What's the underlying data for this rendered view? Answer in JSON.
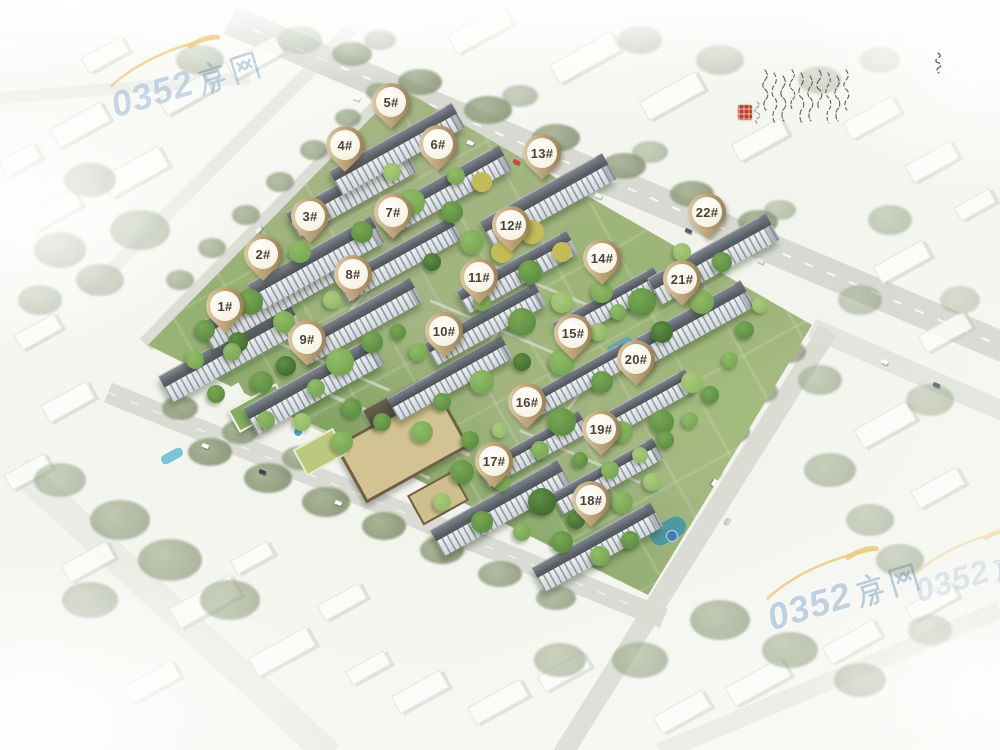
{
  "page": {
    "width": 1000,
    "height": 750,
    "description": "Aerial bird's-eye rendering of a residential compound masterplan with 22 numbered building markers"
  },
  "map": {
    "marker_style": {
      "ring_light": "#e6d7b7",
      "ring_dark": "#8a744c",
      "fill": "#fbf8ef",
      "text_color": "#4a4236"
    },
    "markers": [
      {
        "label": "1#",
        "x": 225,
        "y": 307
      },
      {
        "label": "2#",
        "x": 263,
        "y": 255
      },
      {
        "label": "3#",
        "x": 310,
        "y": 217
      },
      {
        "label": "4#",
        "x": 345,
        "y": 146
      },
      {
        "label": "5#",
        "x": 391,
        "y": 103
      },
      {
        "label": "6#",
        "x": 438,
        "y": 145
      },
      {
        "label": "7#",
        "x": 393,
        "y": 213
      },
      {
        "label": "8#",
        "x": 353,
        "y": 275
      },
      {
        "label": "9#",
        "x": 307,
        "y": 340
      },
      {
        "label": "10#",
        "x": 444,
        "y": 332
      },
      {
        "label": "11#",
        "x": 479,
        "y": 278
      },
      {
        "label": "12#",
        "x": 511,
        "y": 226
      },
      {
        "label": "13#",
        "x": 542,
        "y": 154
      },
      {
        "label": "14#",
        "x": 602,
        "y": 259
      },
      {
        "label": "15#",
        "x": 573,
        "y": 334
      },
      {
        "label": "16#",
        "x": 527,
        "y": 403
      },
      {
        "label": "17#",
        "x": 494,
        "y": 462
      },
      {
        "label": "18#",
        "x": 591,
        "y": 501
      },
      {
        "label": "19#",
        "x": 601,
        "y": 430
      },
      {
        "label": "20#",
        "x": 636,
        "y": 360
      },
      {
        "label": "21#",
        "x": 682,
        "y": 280
      },
      {
        "label": "22#",
        "x": 707,
        "y": 213
      }
    ]
  },
  "watermark": {
    "text": "0352房网",
    "digits": "0352",
    "cn_chars": "房网",
    "color": "#3e76b0",
    "swoosh_color": "#e9b23c",
    "instances": [
      {
        "x": 100,
        "y": 66,
        "rot": -17,
        "scale": 1.0,
        "opacity": 0.55
      },
      {
        "x": 756,
        "y": 578,
        "rot": -17,
        "scale": 1.02,
        "opacity": 0.62
      },
      {
        "x": 905,
        "y": 556,
        "rot": -17,
        "scale": 0.9,
        "opacity": 0.3
      }
    ]
  },
  "inscription": {
    "ink_color": "#3a3a34",
    "seal_color": "#b5452f",
    "columns": 10
  }
}
